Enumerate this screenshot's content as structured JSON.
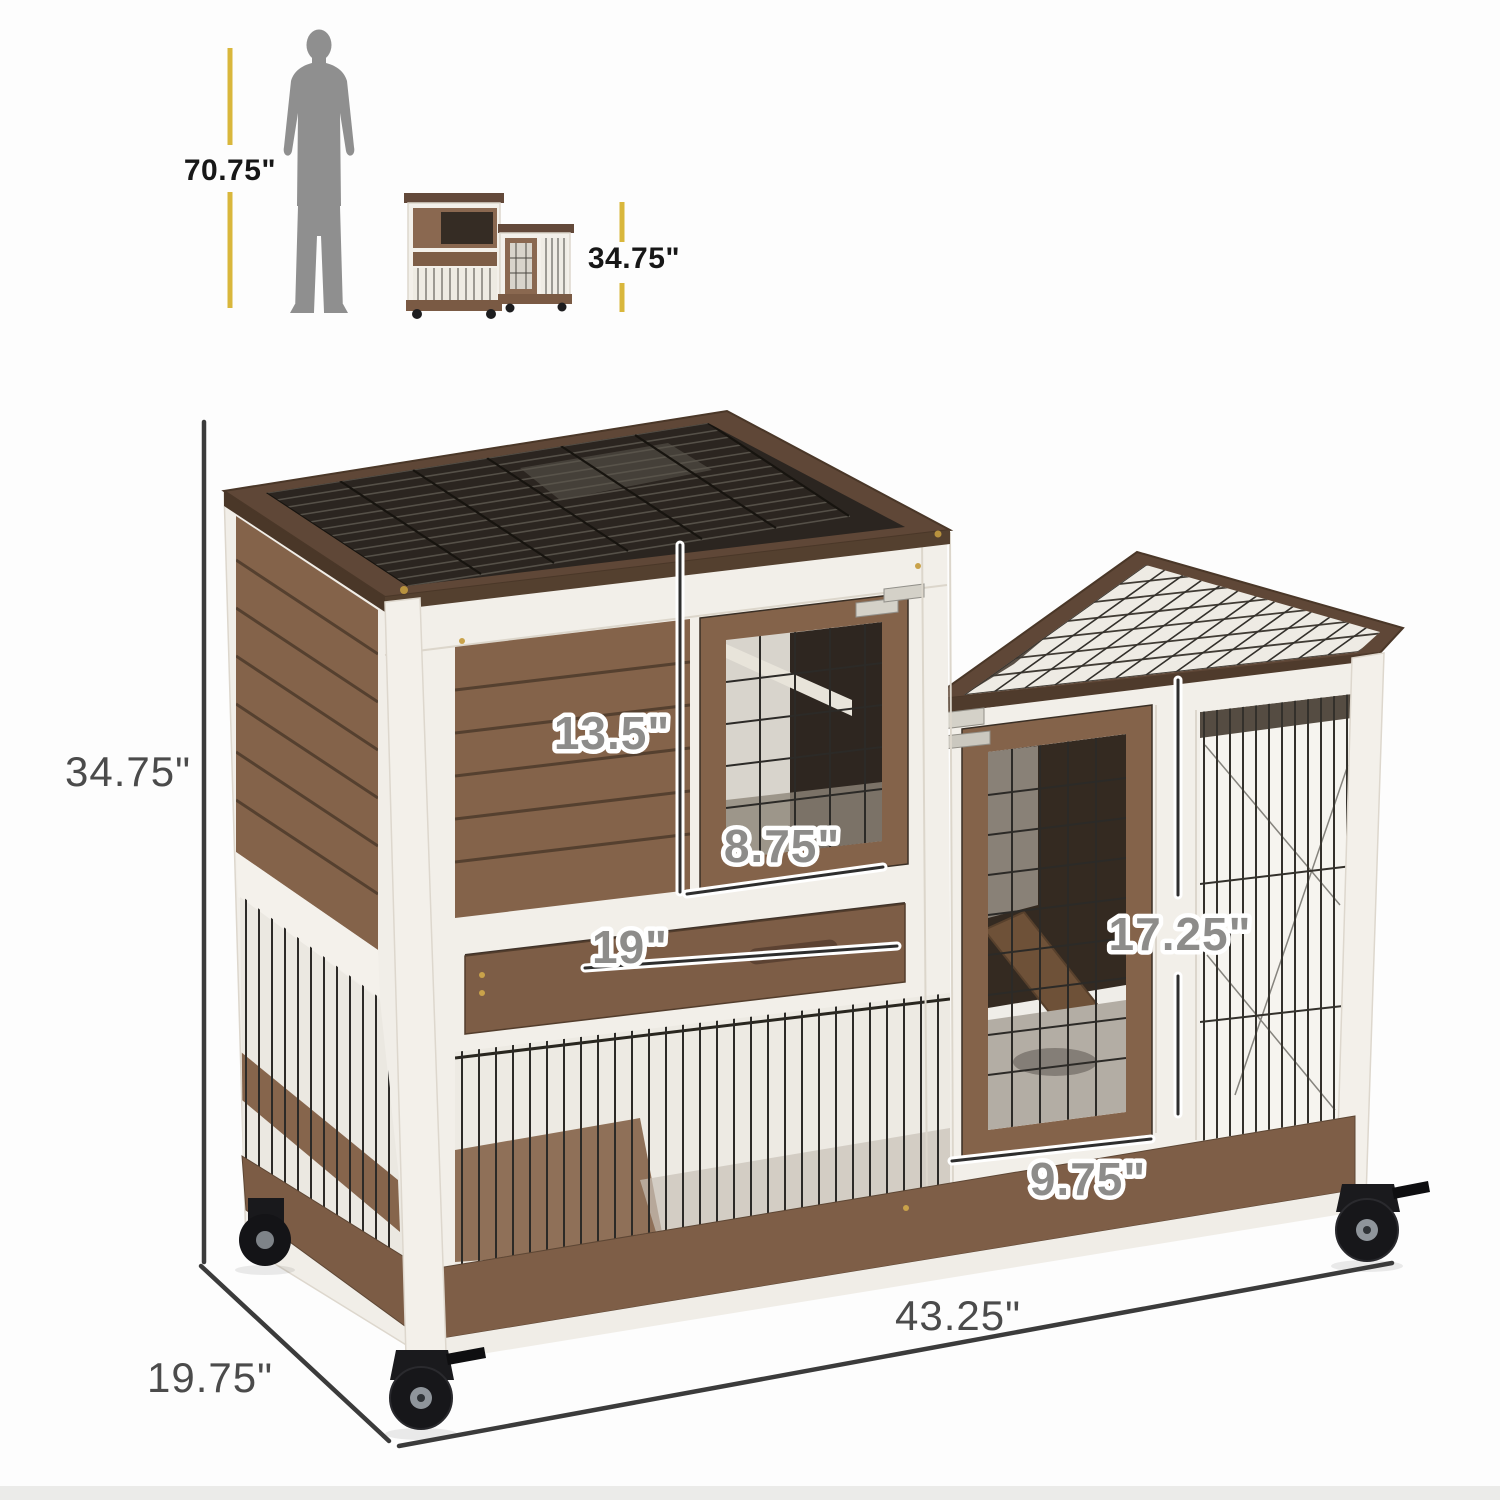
{
  "title": "Rabbit hutch product dimensions diagram",
  "background": "#fdfdfd",
  "labels": {
    "person_height": "70.75\"",
    "thumb_height": "34.75\"",
    "overall_height": "34.75\"",
    "overall_width": "43.25\"",
    "overall_depth": "19.75\"",
    "upper_door_height": "13.5\"",
    "upper_door_width": "8.75\"",
    "drawer_width": "19\"",
    "side_door_height": "17.25\"",
    "side_door_width": "9.75\""
  },
  "colors": {
    "scale_line_yellow": "#d9b73c",
    "bounding_dimension_line": "#3b3b3b",
    "overlay_label_fill": "#8d8c8a",
    "bold_label": "#171717",
    "thin_label": "#4b4b4b",
    "silhouette_gray": "#8f8f8f",
    "wood_medium": "#84634a",
    "wood_roof_frame": "#5f4737",
    "wood_base": "#7e5e47",
    "frame_white": "#f3f0ea",
    "wire_dark": "#2d2a26"
  },
  "icons": {
    "person_silhouette": "standing-man",
    "product_thumbnail": "rabbit-hutch-front-view"
  }
}
